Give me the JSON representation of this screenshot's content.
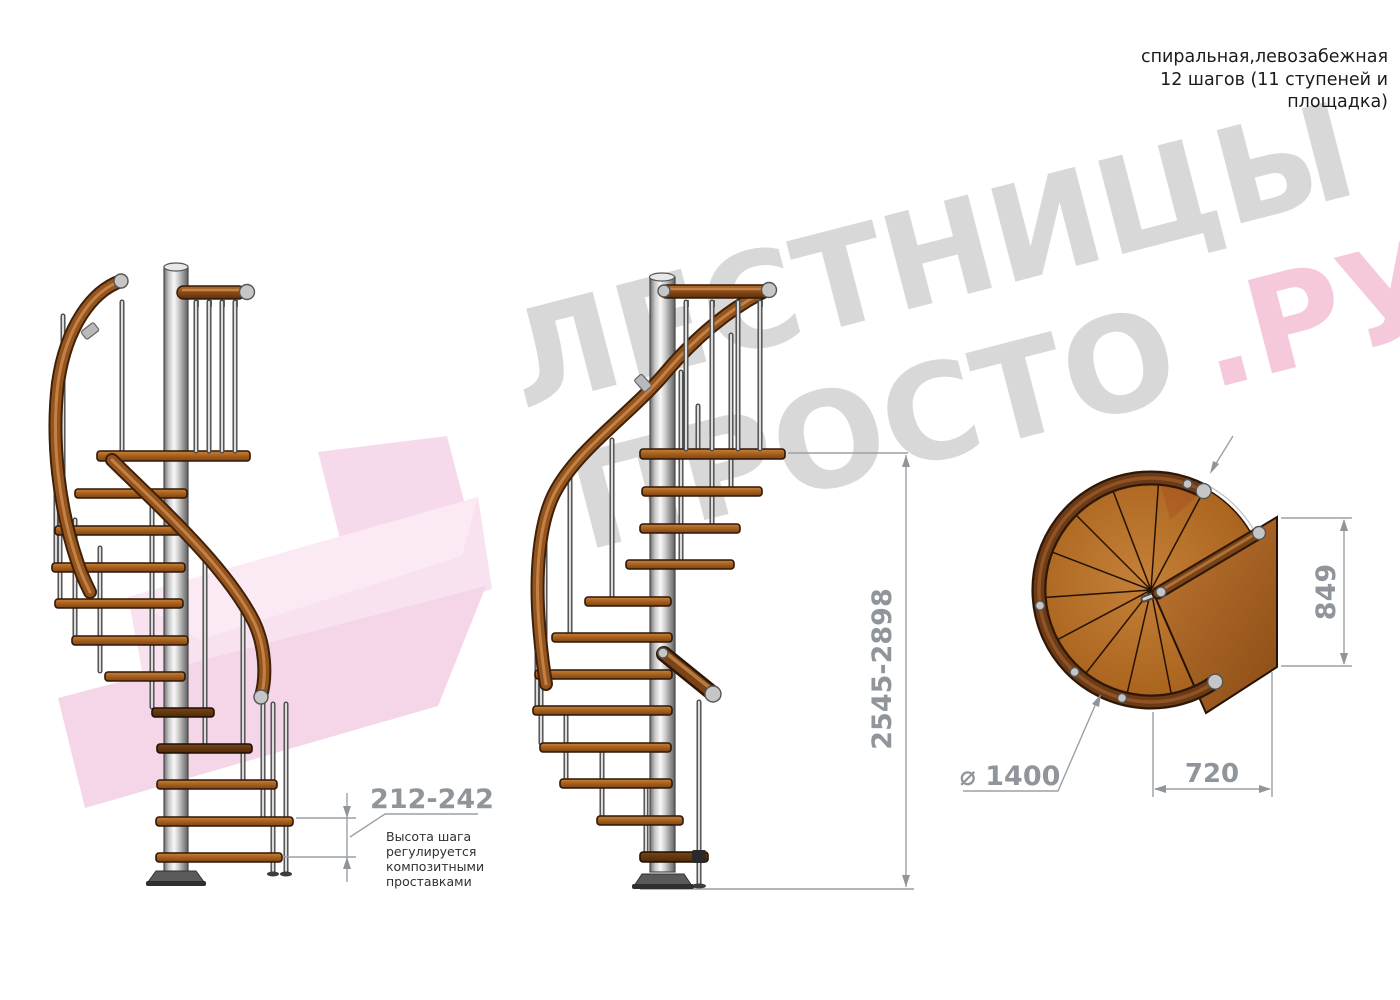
{
  "header": {
    "lines": [
      "спиральная,левозабежная",
      "12 шагов (11 ступеней и",
      "площадка)"
    ]
  },
  "watermark": {
    "line1": "ЛЕСТНИЦЫ",
    "line2_gray": "ПРОСТО",
    "line2_pink": ".РУ"
  },
  "dimensions": {
    "step_height": "212-242",
    "step_height_note": [
      "Высота шага",
      "регулируется",
      "композитными",
      "проставками"
    ],
    "total_height": "2545-2898",
    "platform_side": "849",
    "platform_width": "720",
    "diameter": "⌀ 1400"
  },
  "colors": {
    "wood": "#a9621f",
    "handrail": "#8a4a16",
    "metal": "#c9c9c9",
    "dimension": "#8f959a",
    "watermark_gray": "#b2b2b2",
    "watermark_pink": "#ec9ac0",
    "pink_arrow": "#f6d7ea",
    "note_text": "#303030"
  }
}
